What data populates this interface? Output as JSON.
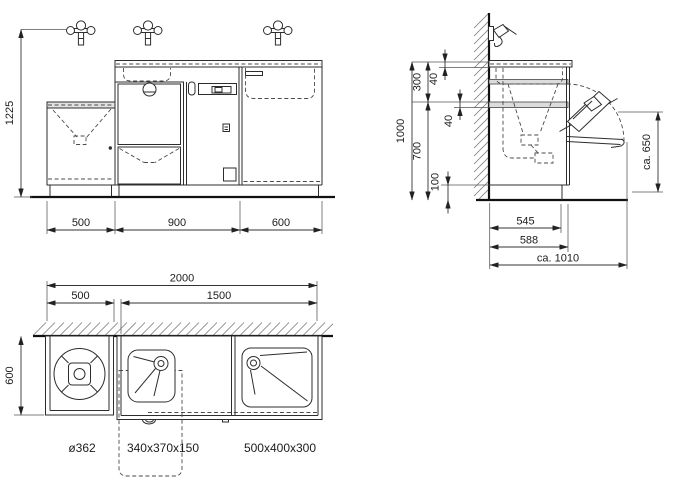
{
  "front_view": {
    "height": "1225",
    "width_left": "500",
    "width_middle": "900",
    "width_right": "600"
  },
  "side_view": {
    "total_height": "1000",
    "top_section": "300",
    "counter_thickness": "40",
    "bottom_section": "700",
    "rail_thickness": "40",
    "plinth_height": "100",
    "open_height": "ca. 650",
    "depth_body": "545",
    "depth_total": "588",
    "depth_open": "ca. 1010"
  },
  "plan_view": {
    "total_width": "2000",
    "left_width": "500",
    "right_width": "1500",
    "depth": "600",
    "round_basin_label": "ø362",
    "middle_sink_label": "340x370x150",
    "right_sink_label": "500x400x300"
  }
}
